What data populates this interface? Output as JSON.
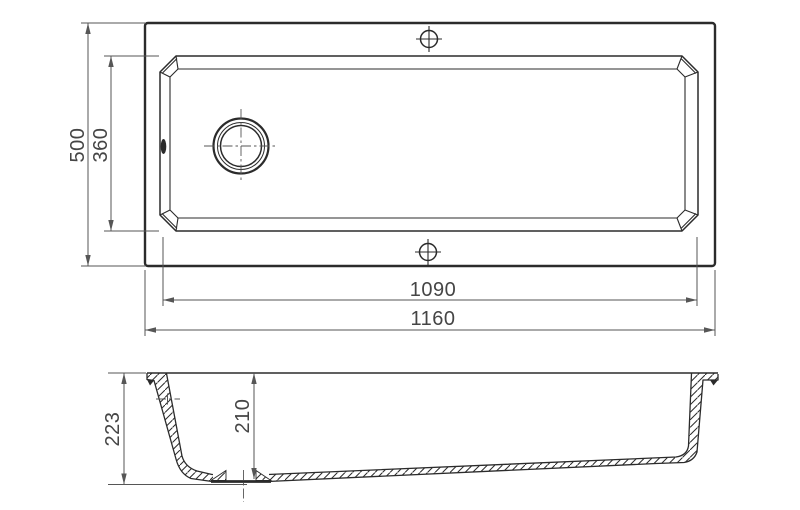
{
  "colors": {
    "line": "#2b2b2b",
    "dimension_line": "#565656",
    "text": "#454545",
    "background": "#ffffff"
  },
  "top_view": {
    "dims": {
      "overall_depth": "500",
      "bowl_depth": "360",
      "bowl_width": "1090",
      "overall_width": "1160"
    }
  },
  "side_view": {
    "dims": {
      "overall_height": "223",
      "inner_depth": "210"
    }
  }
}
